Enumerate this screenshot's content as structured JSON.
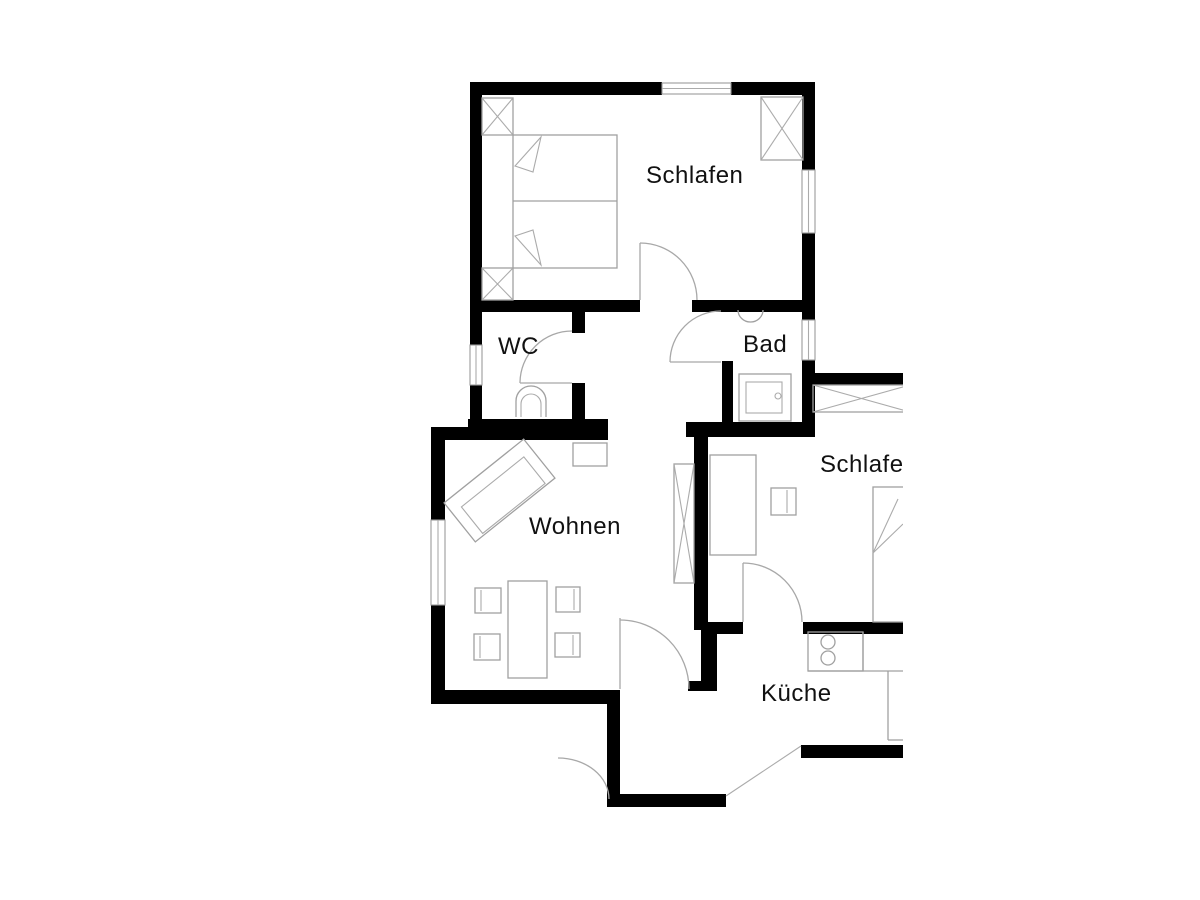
{
  "page": {
    "background": "#ffffff"
  },
  "plan": {
    "type": "apartment-floor-plan",
    "colors": {
      "wall": "#000000",
      "furniture_line": "#a0a0a0",
      "door_arc": "#a8a8a8",
      "label_text": "#111111",
      "background": "#ffffff"
    },
    "rooms": {
      "bedroom1": {
        "label": "Schlafen"
      },
      "wc": {
        "label": "WC"
      },
      "bath": {
        "label": "Bad"
      },
      "living": {
        "label": "Wohnen"
      },
      "bedroom2": {
        "label": "Schlafen"
      },
      "kitchen": {
        "label": "Küche"
      }
    }
  }
}
